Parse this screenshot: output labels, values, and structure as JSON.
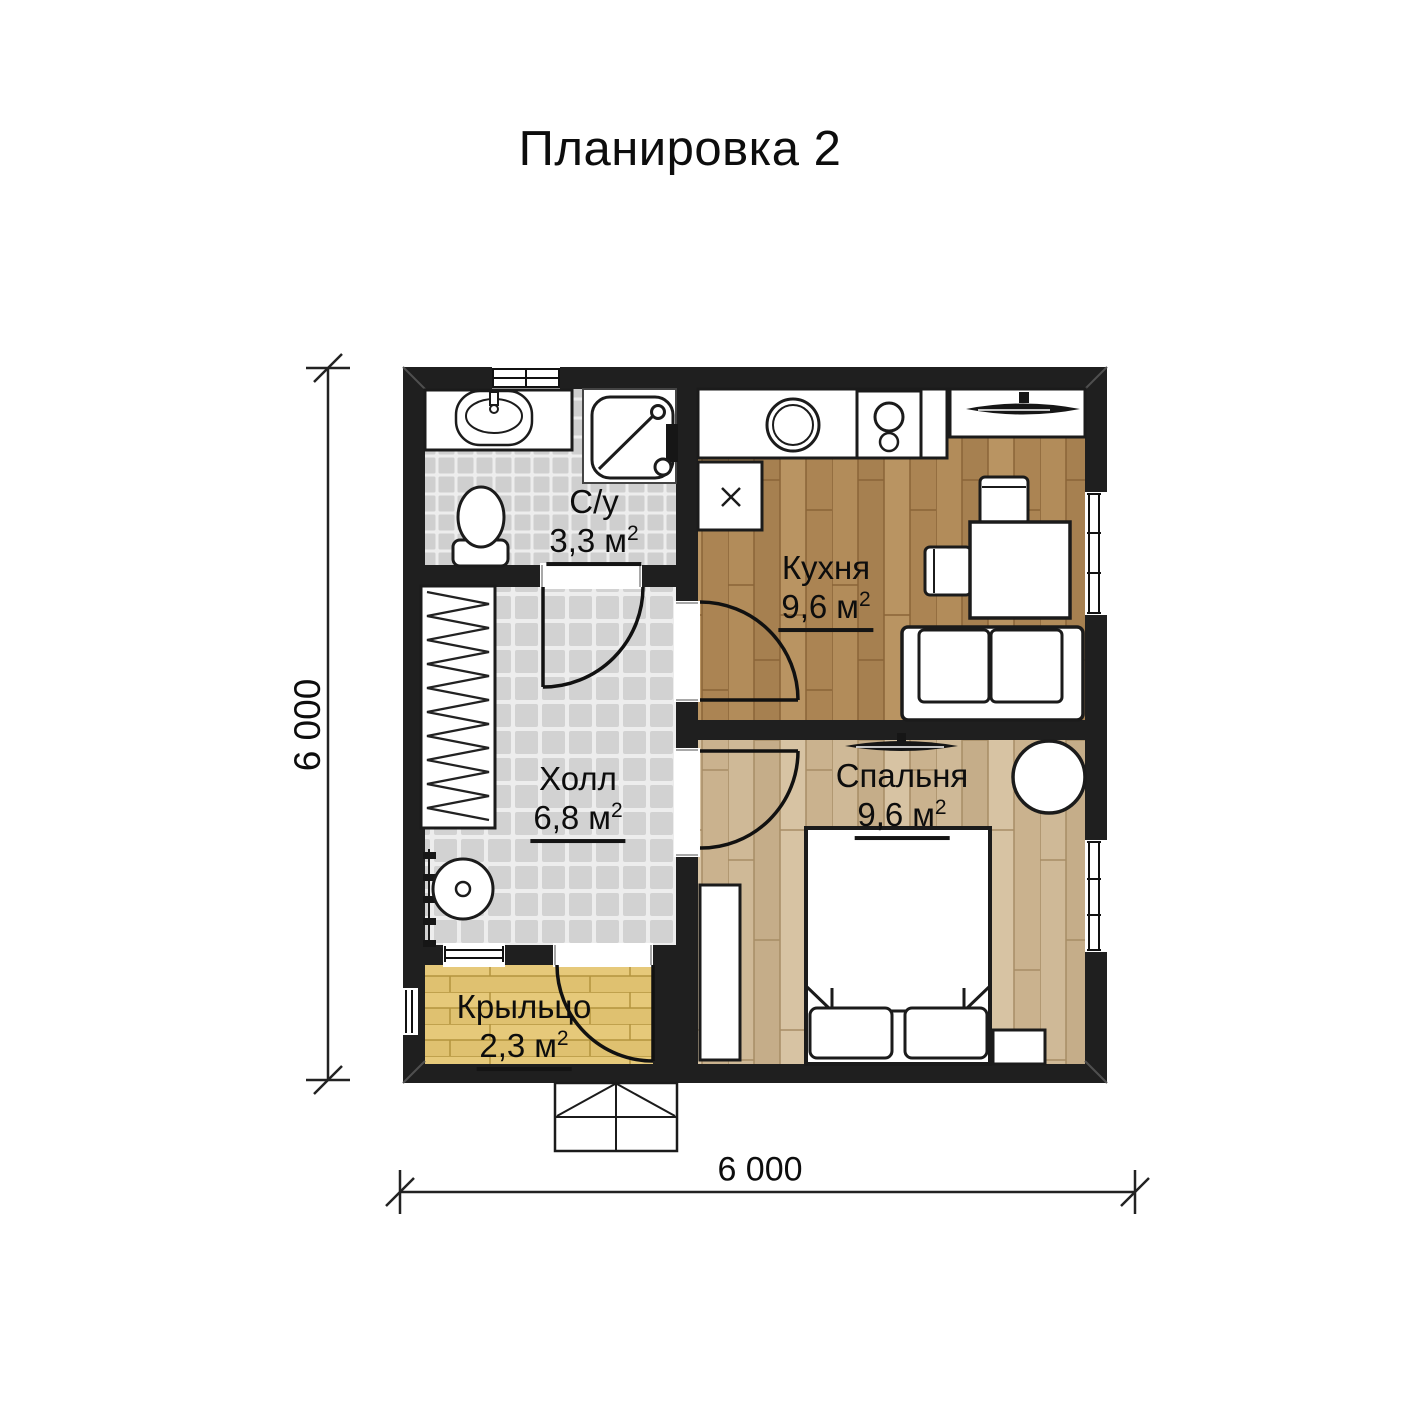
{
  "title": "Планировка 2",
  "dimensions": {
    "width": "6 000",
    "height": "6 000"
  },
  "rooms": [
    {
      "id": "bathroom",
      "label": "С/у",
      "area": "3,3",
      "unit": "м",
      "area_sup": "2"
    },
    {
      "id": "kitchen",
      "label": "Кухня",
      "area": "9,6",
      "unit": "м",
      "area_sup": "2"
    },
    {
      "id": "hall",
      "label": "Холл",
      "area": "6,8",
      "unit": "м",
      "area_sup": "2"
    },
    {
      "id": "bedroom",
      "label": "Спальня",
      "area": "9,6",
      "unit": "м",
      "area_sup": "2"
    },
    {
      "id": "porch",
      "label": "Крыльцо",
      "area": "2,3",
      "unit": "м",
      "area_sup": "2"
    }
  ],
  "colors": {
    "background": "#ffffff",
    "wall": "#1f1f1f",
    "tile_floor": "#d2d2d2",
    "kitchen_floor": "#b08a58",
    "bedroom_floor": "#cdb795",
    "porch_floor": "#e3c674",
    "furniture_outline": "#1b1b1b"
  },
  "furniture": {
    "bathroom": [
      "sink",
      "shower",
      "toilet"
    ],
    "kitchen": [
      "counter",
      "round-sink",
      "cooktop",
      "appliance-box",
      "tv-stand",
      "dining-table",
      "chairs",
      "sofa"
    ],
    "hall": [
      "wardrobe-with-hangers",
      "coat-hooks",
      "stool"
    ],
    "bedroom": [
      "tv",
      "double-bed",
      "pillows",
      "wardrobe",
      "pouf",
      "nightstand"
    ],
    "porch": [
      "entrance-steps"
    ]
  }
}
